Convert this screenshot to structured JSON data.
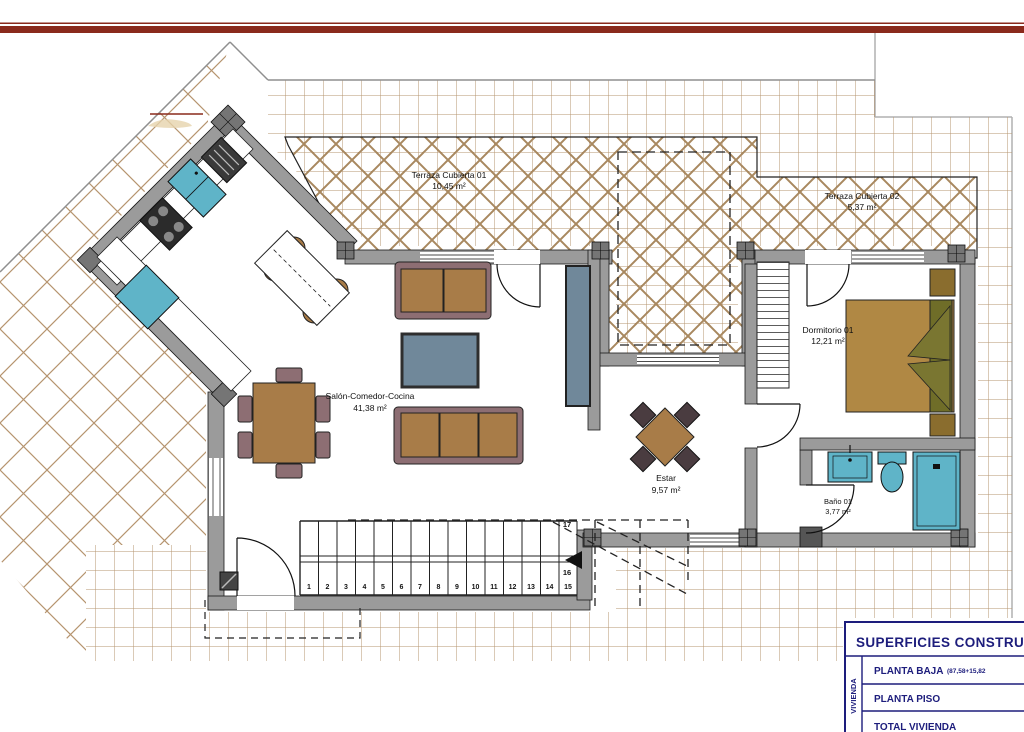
{
  "plan": {
    "rooms": {
      "terraza1": {
        "name": "Terraza Cubierta 01",
        "area": "10,45 m²"
      },
      "terraza2": {
        "name": "Terraza Cubierta 02",
        "area": "5,37 m²"
      },
      "dormitorio": {
        "name": "Dormitorio 01",
        "area": "12,21 m²"
      },
      "salon": {
        "name": "Salón-Comedor-Cocina",
        "area": "41,38 m²"
      },
      "estar": {
        "name": "Estar",
        "area": "9,57 m²"
      },
      "bano": {
        "name": "Baño 01",
        "area": "3,77 m²"
      }
    },
    "stairs": {
      "steps": [
        "1",
        "2",
        "3",
        "4",
        "5",
        "6",
        "7",
        "8",
        "9",
        "10",
        "11",
        "12",
        "13",
        "14",
        "15"
      ],
      "upper_marks": {
        "m16": "16",
        "m17": "17"
      }
    }
  },
  "title_block": {
    "header": "SUPERFICIES CONSTRUID",
    "side_label": "VIVIENDA",
    "rows": [
      {
        "label": "PLANTA BAJA",
        "note": "(87,58+15,82"
      },
      {
        "label": "PLANTA PISO",
        "note": ""
      },
      {
        "label": "TOTAL VIVIENDA",
        "note": ""
      }
    ]
  },
  "colors": {
    "accent_red": "#8a2a1c",
    "navy": "#1d1d7c",
    "wall_gray": "#9b9b9b",
    "tile_line": "#b6946f",
    "hatch_line": "#a8885f",
    "furniture_brown": "#a87c48",
    "furniture_mauve": "#8d6e73",
    "fixture_cyan": "#5fb4c8",
    "table_blue": "#70889a",
    "bed_brown": "#b08844"
  }
}
